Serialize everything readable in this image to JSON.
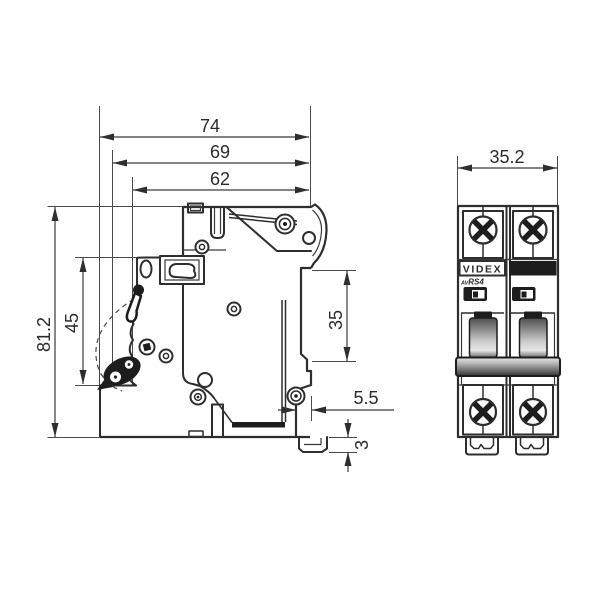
{
  "side_view": {
    "dims": {
      "overall_width": "74",
      "width_secondary": "69",
      "width_inner": "62",
      "overall_height": "81.2",
      "front_section_height": "45",
      "din_rail_height": "35",
      "rear_offset": "5.5",
      "clip_protrusion": "3"
    }
  },
  "front_view": {
    "dims": {
      "overall_width": "35.2"
    },
    "brand": "VIDEX",
    "model_prefix": "AV",
    "model": "RS4"
  },
  "colors": {
    "line": "#2e2e2e",
    "background": "#ffffff",
    "handle_dark": "#4f4f4f",
    "handle_light": "#e6e6e6"
  }
}
